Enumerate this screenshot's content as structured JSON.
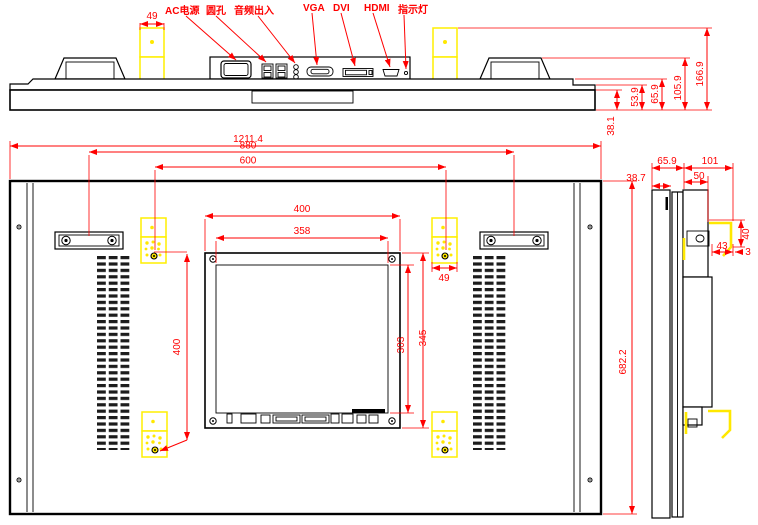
{
  "drawing": {
    "kind": "engineering-dimension-drawing",
    "subject": "wall-mount LCD display, top / rear / side views"
  },
  "colors": {
    "dimension_red": "#ff0000",
    "bracket_yellow": "#ffe800",
    "outline_black": "#000000",
    "background": "#ffffff"
  },
  "port_labels": {
    "ac_power": "AC电源",
    "round_hole": "圆孔",
    "audio_io": "音频出入",
    "vga": "VGA",
    "dvi": "DVI",
    "hdmi": "HDMI",
    "indicator": "指示灯"
  },
  "dims": {
    "top": {
      "bracket_w": "49",
      "edge": "38.1",
      "step": "53.9",
      "body": "65.9",
      "handle": "105.9",
      "overall": "166.9"
    },
    "back": {
      "overall_w": "1211.4",
      "handle_span": "880",
      "vesa_h": "600",
      "vesa_v": "400",
      "box_w": "400",
      "box_inner_w": "358",
      "pad_w": "49",
      "box_inner_h": "303",
      "box_h": "345",
      "overall_h": "682.2"
    },
    "side": {
      "front": "38.7",
      "body": "65.9",
      "back": "101",
      "box": "50",
      "hook_w": "43",
      "gap": "3",
      "hook_h": "40"
    }
  }
}
